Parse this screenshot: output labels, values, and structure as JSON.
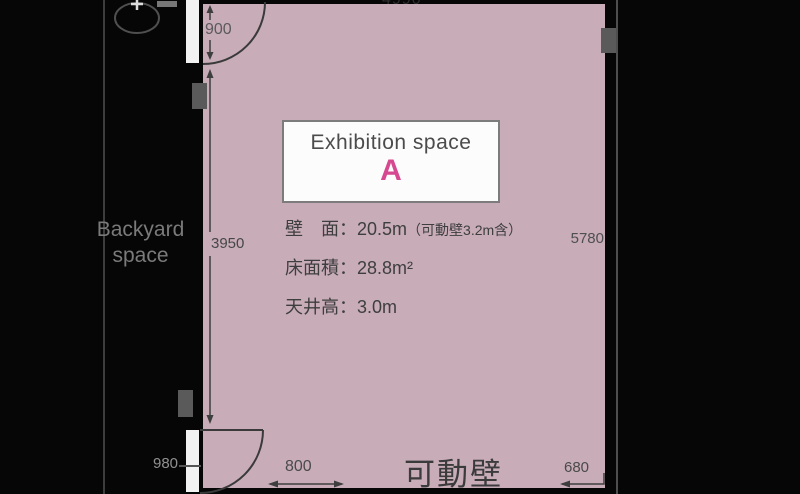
{
  "colors": {
    "room_fill": "#c8acb8",
    "accent_pink": "#d6488f",
    "background": "#060606",
    "line_dark": "#3e3e3e"
  },
  "room": {
    "name_label": "Exhibition space",
    "letter": "A",
    "specs": {
      "wall": "壁　面：20.5m",
      "wall_note": "（可動壁3.2m含）",
      "floor": "床面積：28.8m²",
      "ceiling": "天井高：3.0m"
    },
    "movable_wall": "可動壁"
  },
  "backyard": {
    "line1": "Backyard",
    "line2": "space"
  },
  "dimensions": {
    "top_width": "4990",
    "top_door": "900",
    "left_height": "3950",
    "right_height": "5780",
    "bottom_door": "980",
    "bottom_left": "800",
    "bottom_right": "680"
  }
}
